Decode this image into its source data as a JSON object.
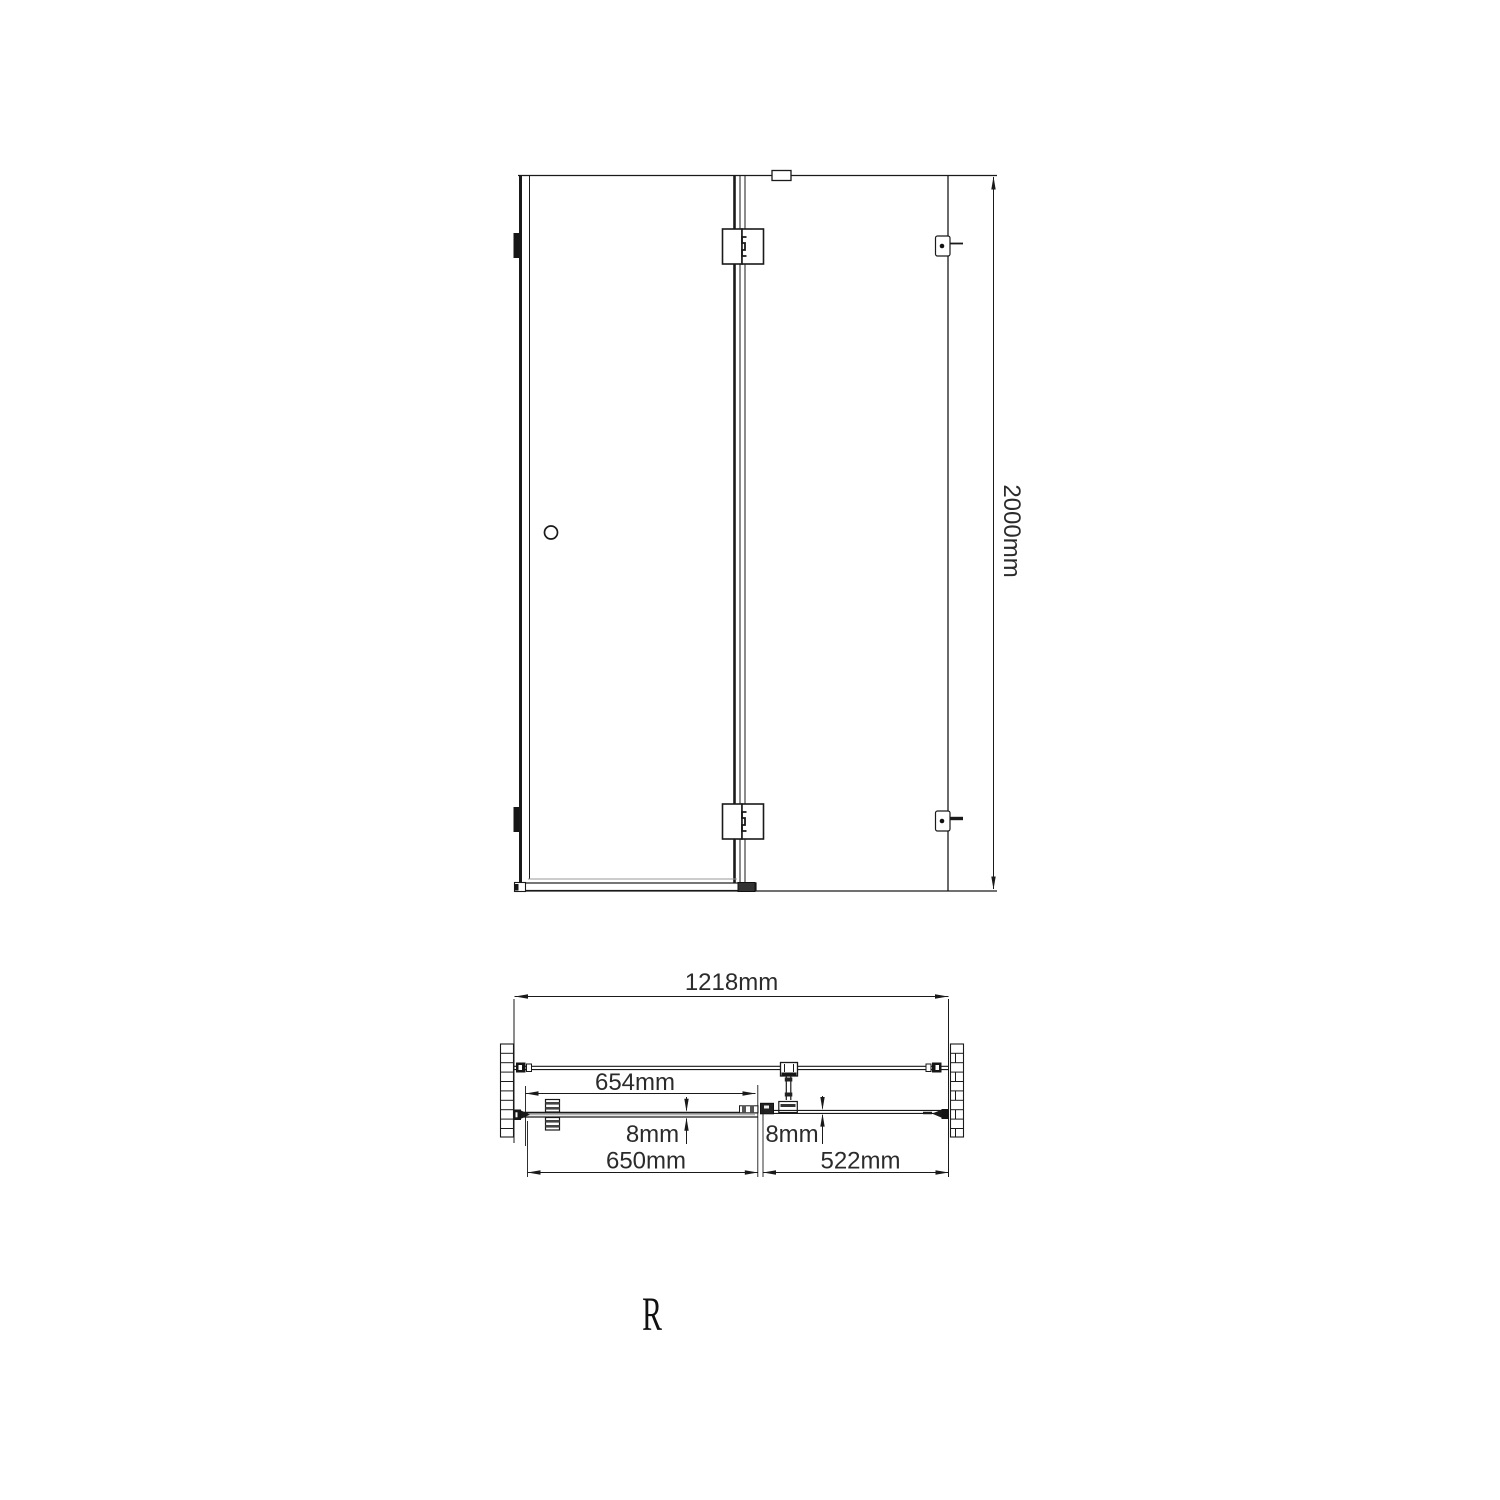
{
  "drawing": {
    "view_elevation": {
      "name": "front elevation of hinged shower door with fixed side panel",
      "height_dim": "2000mm"
    },
    "view_plan": {
      "name": "top plan section through enclosure",
      "total_width_dim": "1218mm",
      "door_glass_width_dim": "654mm",
      "door_glass_thickness_dim": "8mm",
      "side_glass_thickness_dim": "8mm",
      "door_width_dim": "650mm",
      "side_panel_width_dim": "522mm"
    },
    "orientation_label": "R",
    "colors": {
      "line": "#1a1a1a",
      "dimension_text": "#2b2b2b",
      "background": "#ffffff"
    }
  }
}
